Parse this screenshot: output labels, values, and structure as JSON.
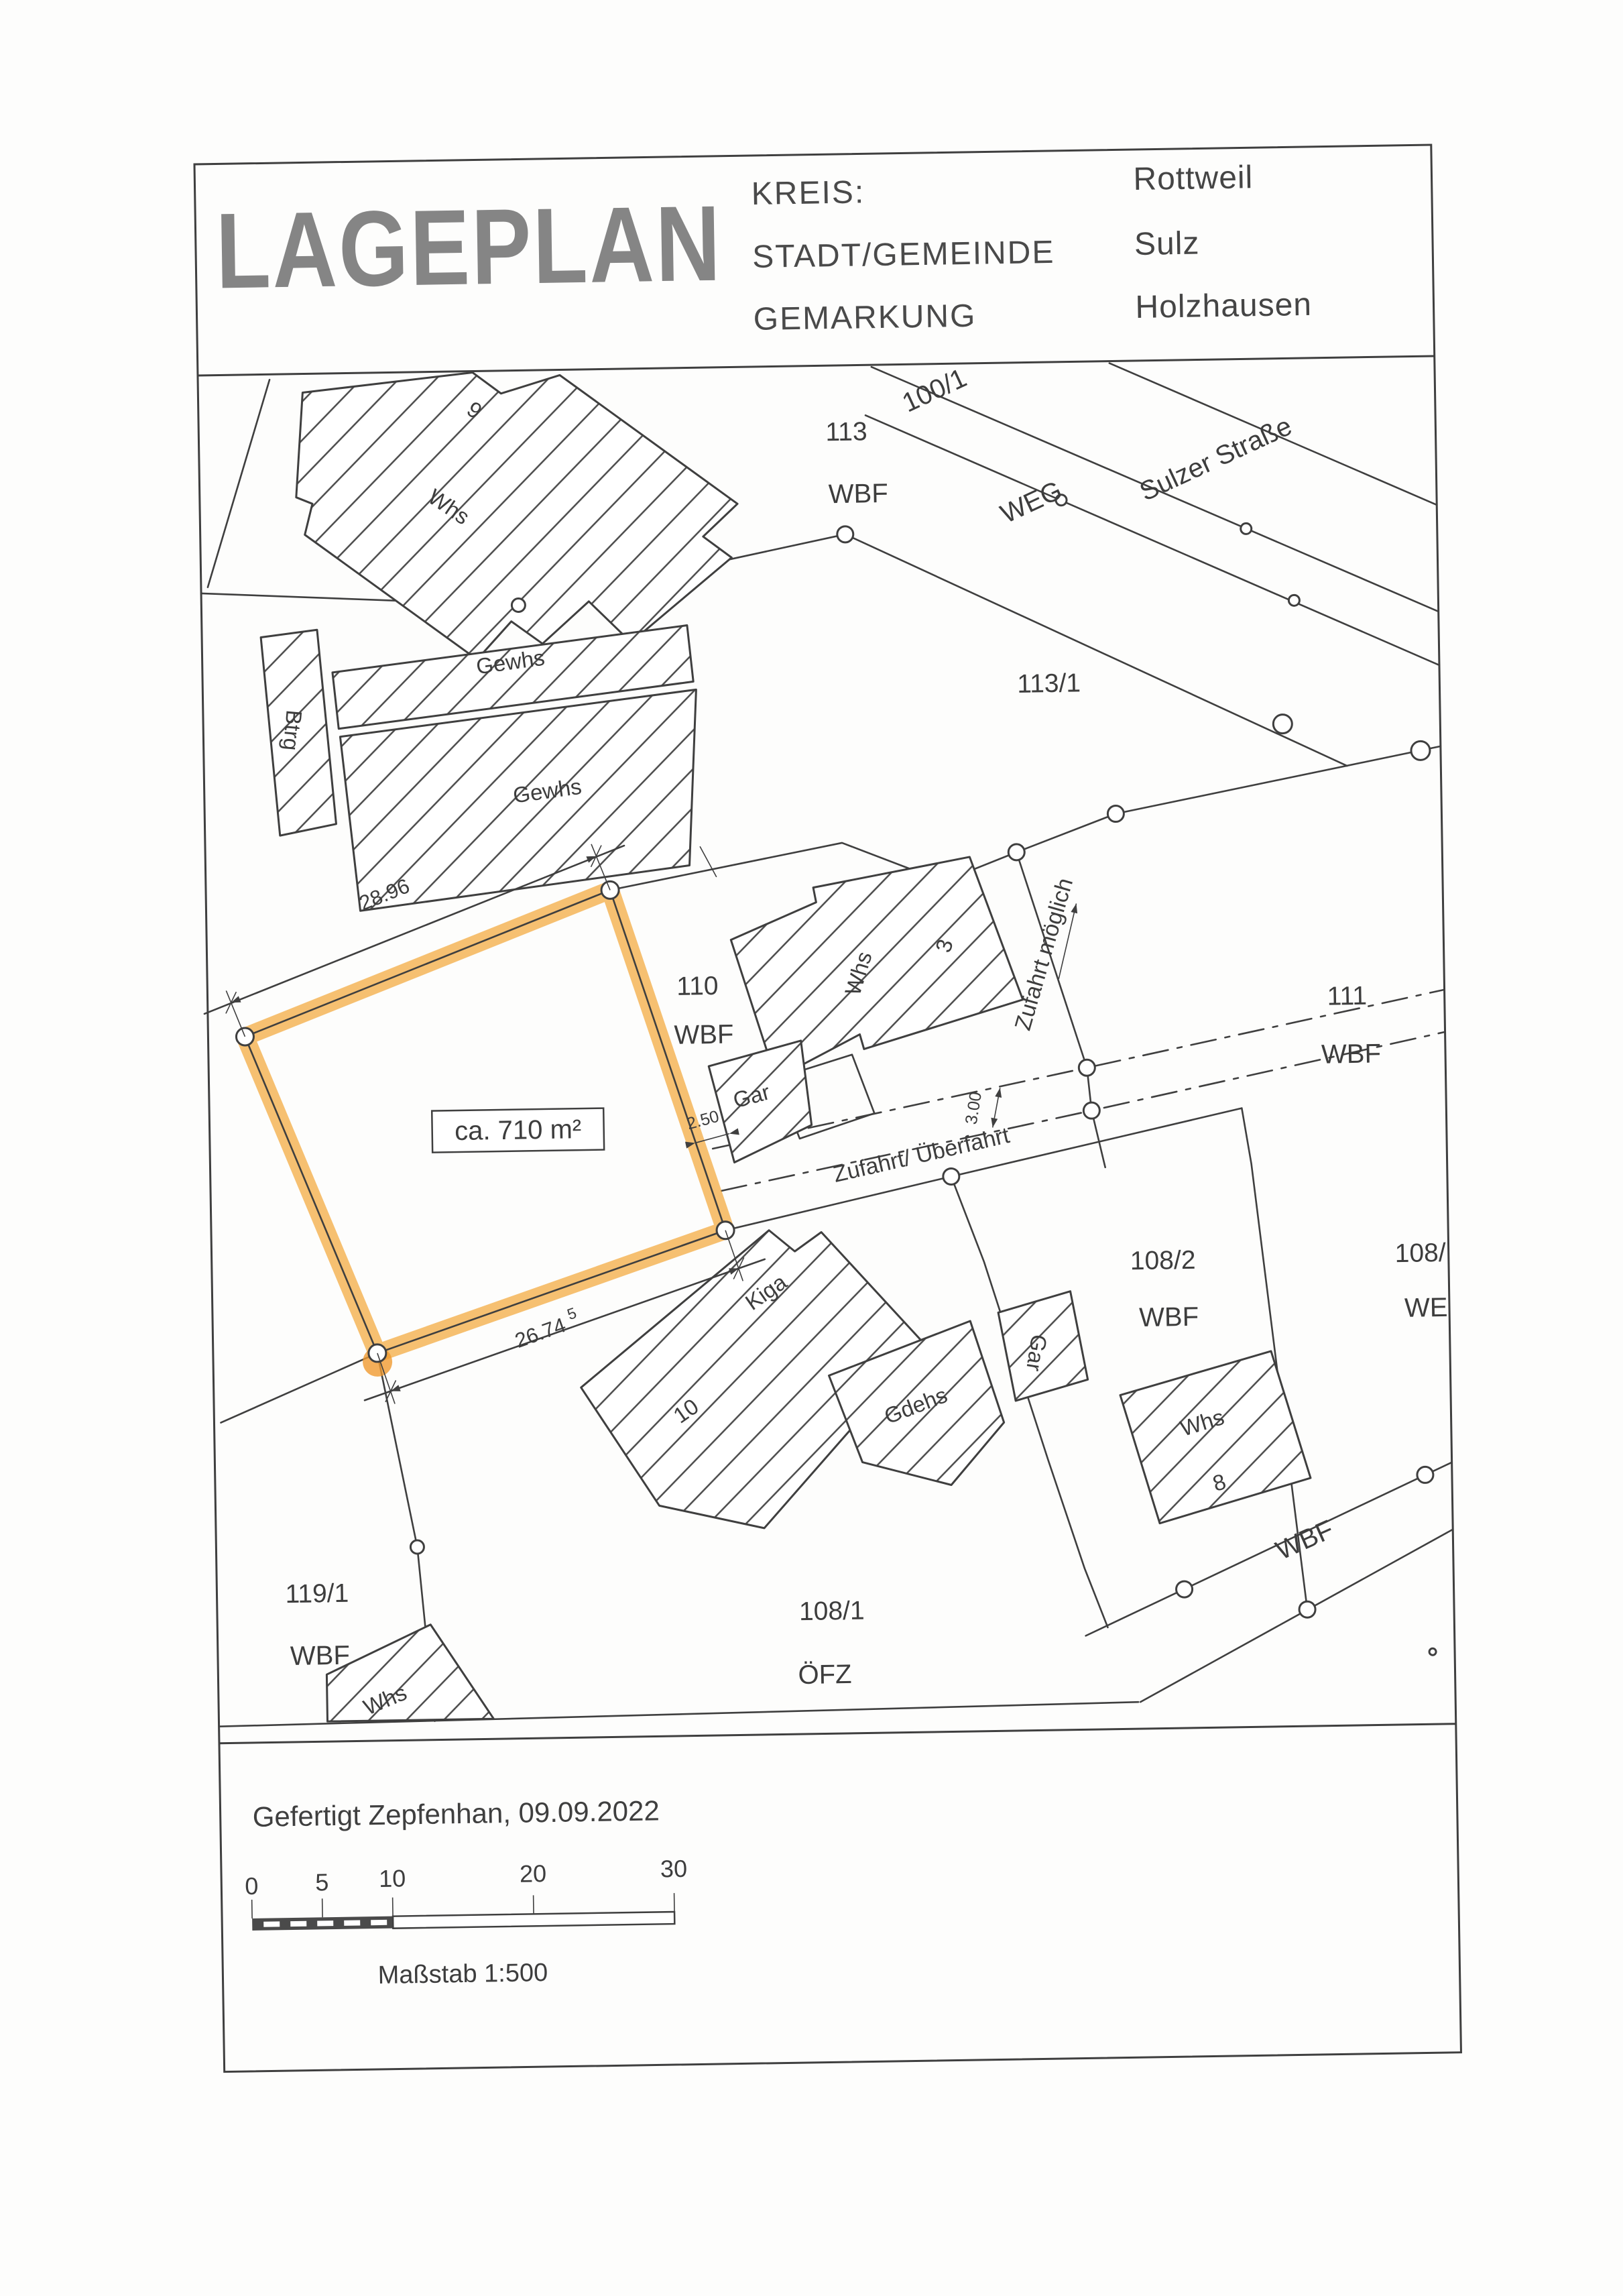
{
  "header": {
    "title": "LAGEPLAN",
    "rows": [
      {
        "label": "KREIS:",
        "value": "Rottweil"
      },
      {
        "label": "STADT/GEMEINDE",
        "value": "Sulz"
      },
      {
        "label": "GEMARKUNG",
        "value": "Holzhausen"
      }
    ]
  },
  "map": {
    "roads": {
      "p100": "100/1",
      "weg": "WEG",
      "sulzer": "Sulzer Straße"
    },
    "parcels": {
      "p113": {
        "number": "113",
        "usage": "WBF"
      },
      "p113_1": {
        "number": "113/1",
        "usage": ""
      },
      "p111": {
        "number": "111",
        "usage": "WBF"
      },
      "p110": {
        "number": "110",
        "usage": "WBF"
      },
      "p108_2": {
        "number": "108/2",
        "usage": "WBF"
      },
      "p108_1": {
        "number": "108/1",
        "usage": "ÖFZ"
      },
      "p119_1": {
        "number": "119/1",
        "usage": "WBF"
      },
      "p108_r": {
        "number": "108/",
        "usage": "WE"
      },
      "wbf_strip": "WBF"
    },
    "buildings": {
      "whs9": {
        "label": "Whs",
        "number": "9"
      },
      "btrg": {
        "label": "Btrg"
      },
      "gewhs1": {
        "label": "Gewhs"
      },
      "gewhs2": {
        "label": "Gewhs"
      },
      "whs3": {
        "label": "Whs",
        "number": "3"
      },
      "gar110": {
        "label": "Gar"
      },
      "kiga": {
        "label": "Kiga",
        "number": "10"
      },
      "gdehs": {
        "label": "Gdehs"
      },
      "whs8": {
        "label": "Whs",
        "number": "8"
      },
      "gar108": {
        "label": "Gar"
      },
      "whs119": {
        "label": "Whs"
      }
    },
    "plot": {
      "area_label": "ca. 710 m²"
    },
    "dimensions": {
      "top": "28.96",
      "bottom": "26.74",
      "bottom_sup": "5",
      "gap": "2.50",
      "corridor_width": "3.00"
    },
    "access": {
      "corridor": "Zufahrt/ Überfahrt",
      "possible": "Zufahrt möglich"
    }
  },
  "footer": {
    "created": "Gefertigt Zepfenhan, 09.09.2022",
    "scale_label": "Maßstab 1:500",
    "scale_ticks": [
      "0",
      "5",
      "10",
      "20",
      "30"
    ]
  },
  "colors": {
    "highlight": "#F3A83B",
    "line": "#3f3f3f"
  }
}
